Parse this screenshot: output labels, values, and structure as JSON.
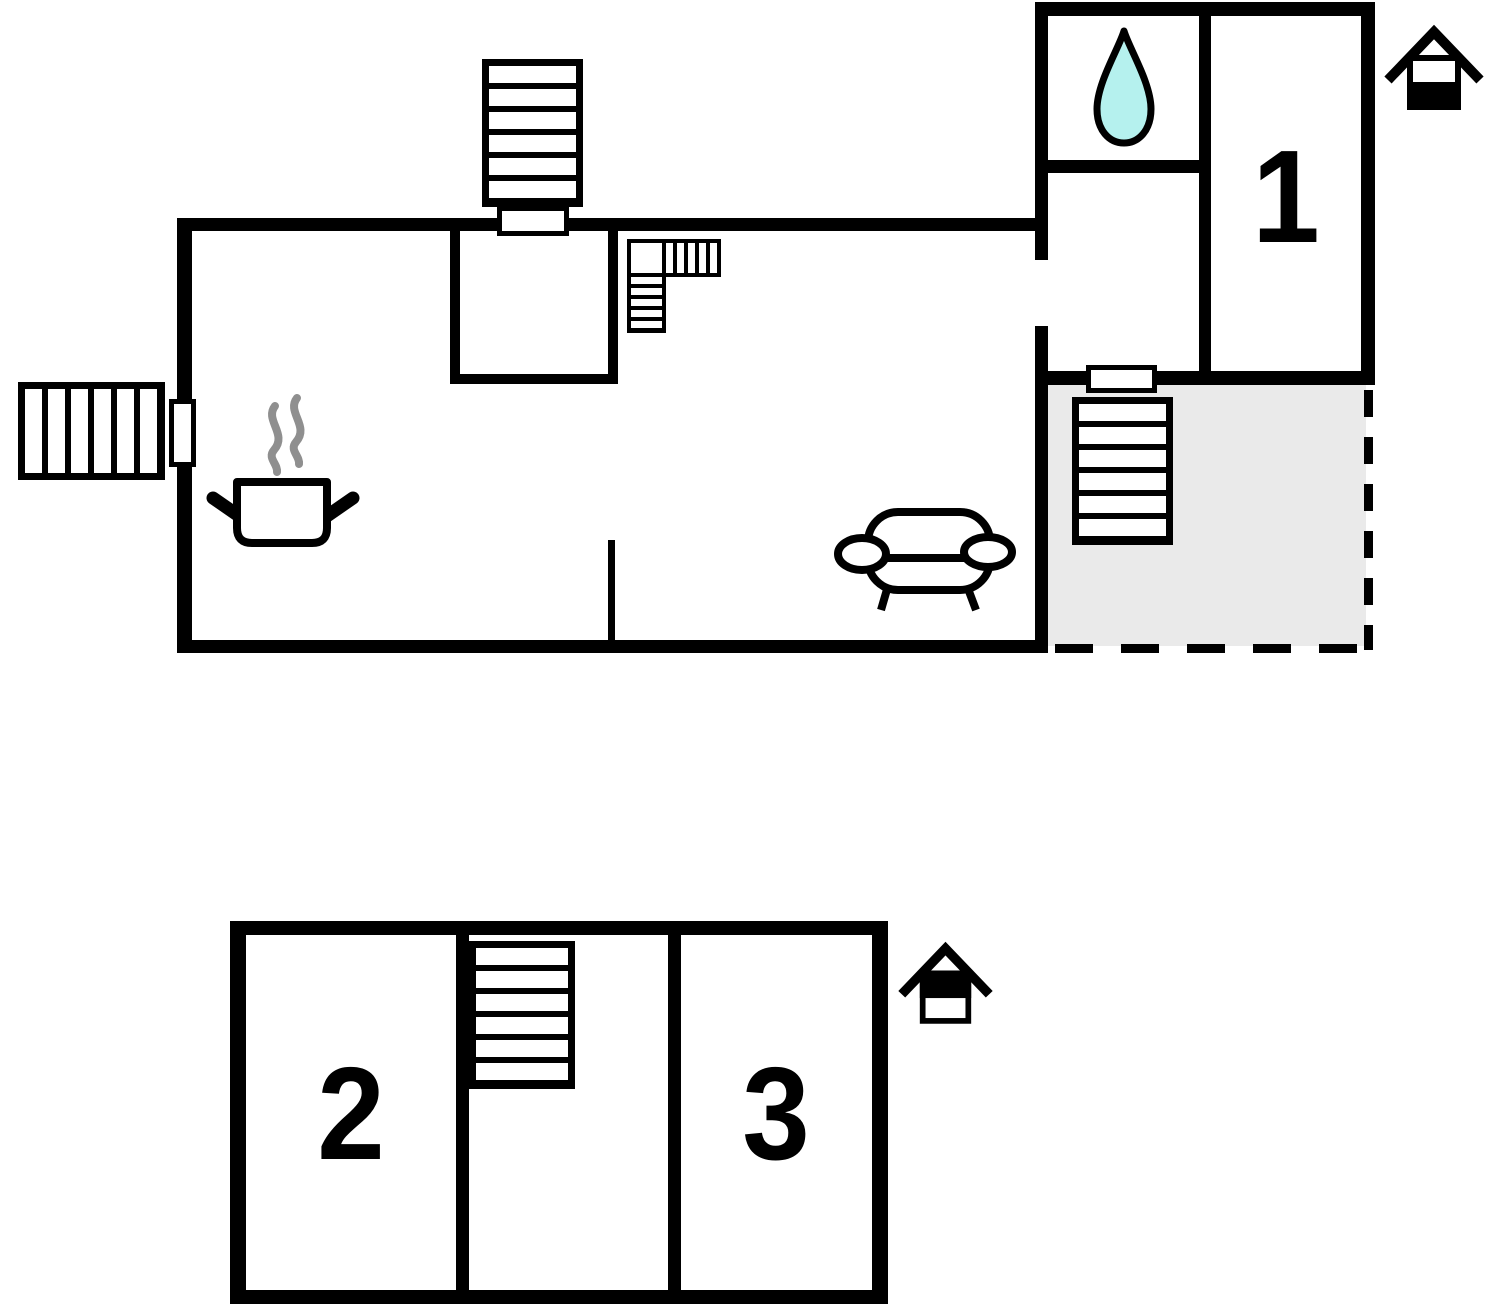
{
  "page": {
    "type": "floor-plan",
    "background": "#ffffff"
  },
  "labels": {
    "room1": "1",
    "room2": "2",
    "room3": "3"
  },
  "icons": {
    "water_drop": "water-drop (bathroom)",
    "cooking_pot": "cooking-pot with steam (kitchen)",
    "sofa": "sofa (living room)",
    "stairs": "staircases with treads",
    "level_ground": "house icon, lower half filled (ground floor indicator)",
    "level_upper": "house icon, upper half filled (upper floor indicator)"
  },
  "colors": {
    "wall": "#000000",
    "water_drop_fill": "#b5f1ee",
    "terrace_fill": "#eaeaea",
    "steam": "#8f8f8f"
  }
}
